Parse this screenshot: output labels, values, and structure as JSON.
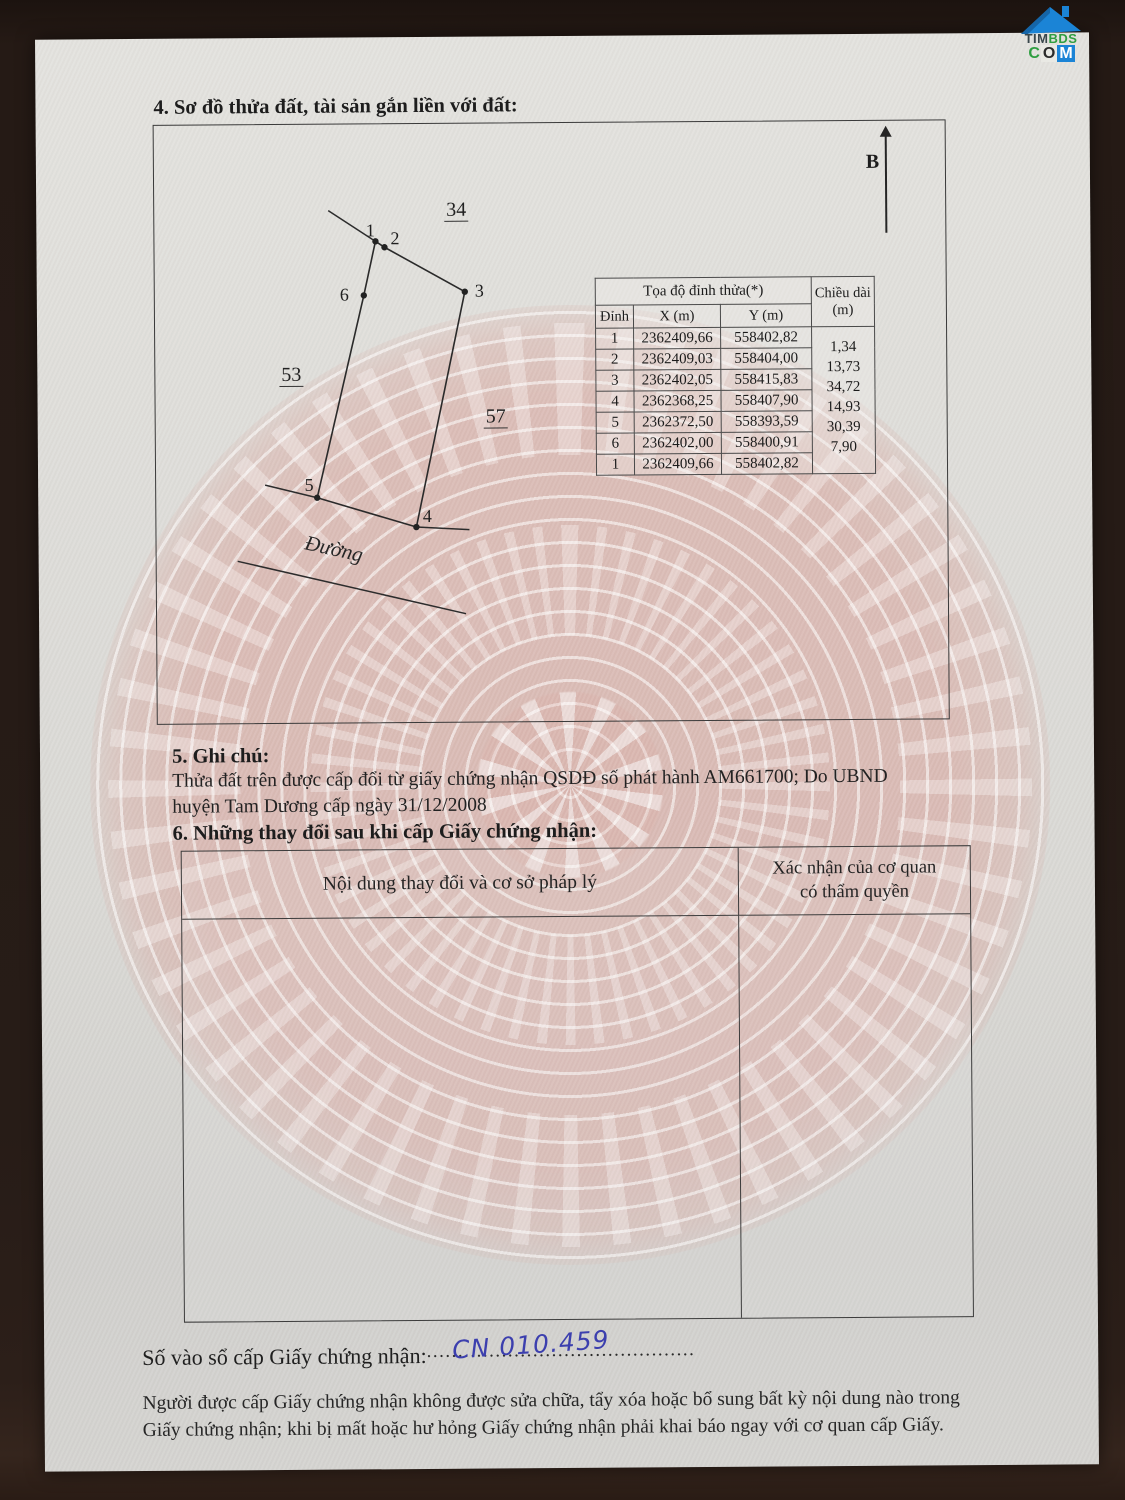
{
  "photo": {
    "logo": {
      "tim": "TIM",
      "bds": "BDS",
      "c": "C",
      "o": "O",
      "m": "M"
    }
  },
  "page": {
    "section4_title": "4. Sơ đồ thửa đất, tài sản gắn liền với đất:",
    "section5_title": "5. Ghi chú:",
    "section5_line1": "Thửa đất trên được cấp đổi từ giấy chứng nhận QSDĐ số phát hành AM661700; Do UBND",
    "section5_line2": "huyện Tam Dương cấp ngày 31/12/2008",
    "section6_title": "6. Những thay đổi sau khi cấp Giấy chứng nhận:",
    "section6_col_left": "Nội dung thay đổi và cơ sở pháp lý",
    "section6_col_right1": "Xác nhận của cơ quan",
    "section6_col_right2": "có thẩm quyền",
    "so_vao_so_label": "Số vào sổ cấp Giấy chứng nhận:",
    "so_vao_so_dots": "................................................................",
    "so_vao_so_value": "CN 010.459",
    "note_line1": "Người được cấp Giấy chứng nhận không được sửa chữa, tẩy xóa hoặc bổ sung bất kỳ nội dung nào trong",
    "note_line2": "Giấy chứng nhận; khi bị mất hoặc hư hỏng Giấy chứng nhận phải khai báo ngay với cơ quan cấp Giấy."
  },
  "diagram": {
    "north_label": "B",
    "road_label": "Đường",
    "labels": {
      "parcel34": "34",
      "parcel53": "53",
      "parcel57": "57"
    },
    "vertices": {
      "v1": "1",
      "v2": "2",
      "v3": "3",
      "v4": "4",
      "v5": "5",
      "v6": "6"
    },
    "table": {
      "title": "Tọa độ đỉnh thửa(*)",
      "col_vertex": "Đỉnh",
      "col_x": "X (m)",
      "col_y": "Y (m)",
      "col_length_1": "Chiều dài",
      "col_length_2": "(m)",
      "rows": [
        {
          "v": "1",
          "x": "2362409,66",
          "y": "558402,82"
        },
        {
          "v": "2",
          "x": "2362409,03",
          "y": "558404,00"
        },
        {
          "v": "3",
          "x": "2362402,05",
          "y": "558415,83"
        },
        {
          "v": "4",
          "x": "2362368,25",
          "y": "558407,90"
        },
        {
          "v": "5",
          "x": "2362372,50",
          "y": "558393,59"
        },
        {
          "v": "6",
          "x": "2362402,00",
          "y": "558400,91"
        },
        {
          "v": "1",
          "x": "2362409,66",
          "y": "558402,82"
        }
      ],
      "lengths": [
        "1,34",
        "13,73",
        "34,72",
        "14,93",
        "30,39",
        "7,90"
      ]
    }
  },
  "colors": {
    "paper": "#dbdad6",
    "background": "#251a15",
    "ink": "#242424",
    "watermark_pink": "#d8a49c",
    "handwriting_blue": "#3c3fae",
    "logo_blue": "#1b84d6",
    "logo_green": "#2f9e41"
  }
}
